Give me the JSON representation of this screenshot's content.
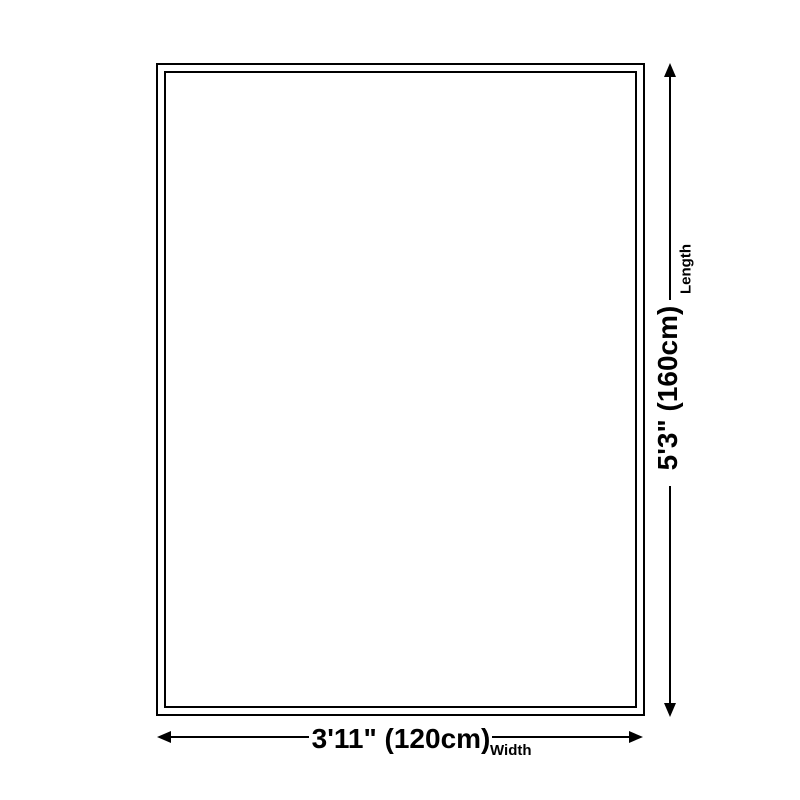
{
  "diagram": {
    "dimensions": {
      "length": {
        "value": "5'3\" (160cm)",
        "label": "Length"
      },
      "width": {
        "value": "3'11\" (120cm)",
        "label": "Width"
      }
    },
    "icons": {
      "length_arrows": [
        "arrow-up-icon",
        "arrow-down-icon"
      ],
      "width_arrows": [
        "arrow-left-icon",
        "arrow-right-icon"
      ]
    },
    "colors": {
      "line": "#000000",
      "background": "#ffffff",
      "rug_fill": "#ffffff"
    }
  }
}
